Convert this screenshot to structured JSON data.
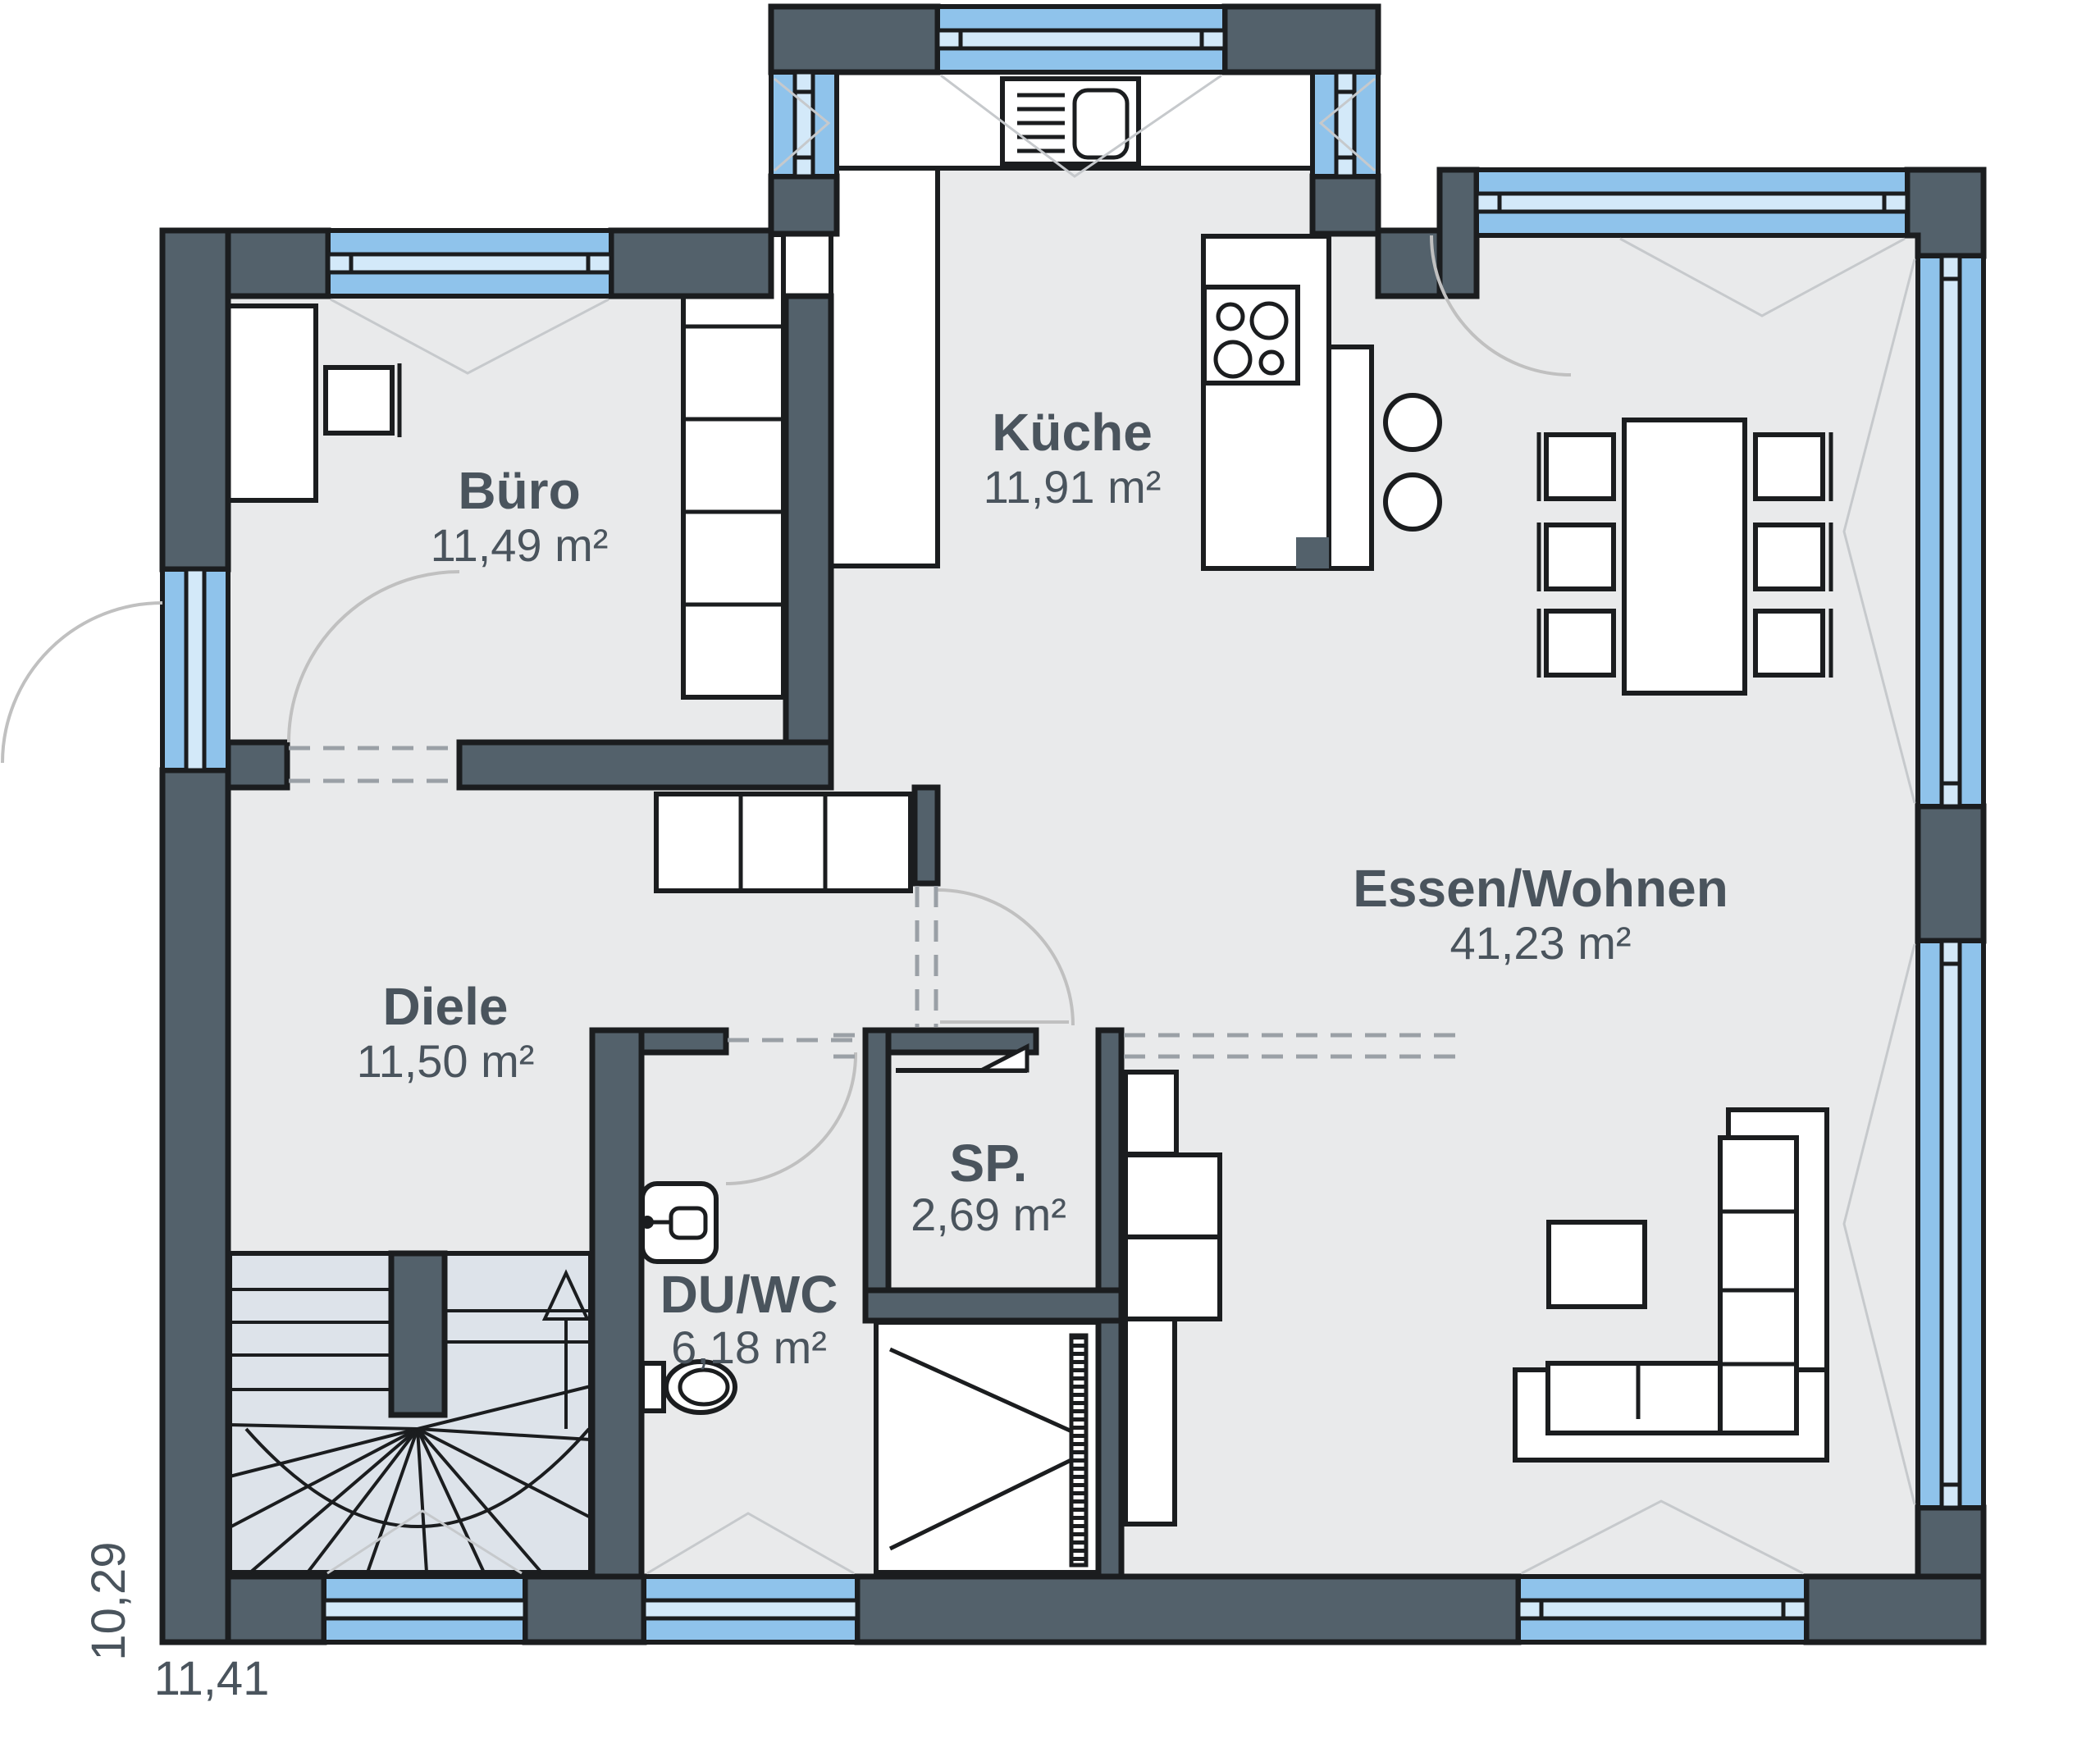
{
  "plan_type": "floor-plan",
  "rooms": {
    "buero": {
      "name": "Büro",
      "area": "11,49 m²"
    },
    "kueche": {
      "name": "Küche",
      "area": "11,91 m²"
    },
    "essen_wohnen": {
      "name": "Essen/Wohnen",
      "area": "41,23 m²"
    },
    "diele": {
      "name": "Diele",
      "area": "11,50 m²"
    },
    "sp": {
      "name": "SP.",
      "area": "2,69 m²"
    },
    "du_wc": {
      "name": "DU/WC",
      "area": "6,18 m²"
    }
  },
  "dimensions": {
    "width": "11,41",
    "height": "10,29"
  },
  "colors": {
    "wall": "#53616b",
    "outline": "#1b1d1f",
    "window_glass": "#8fc3eb",
    "window_frame": "#d3e9f9",
    "floor": "#e9eaeb",
    "stairs_floor": "#dde3ea",
    "label_text": "#4a545d",
    "door_swing": "#c0c0c0"
  },
  "furniture": [
    "desk",
    "office-chair",
    "shelf-unit",
    "hall-wardrobe",
    "kitchen-counter",
    "kitchen-sink",
    "cooktop",
    "breakfast-bar",
    "bar-stools",
    "dining-table",
    "dining-chairs",
    "sideboard",
    "coffee-table",
    "corner-sofa",
    "washbasin",
    "toilet",
    "shower",
    "winder-staircase"
  ]
}
